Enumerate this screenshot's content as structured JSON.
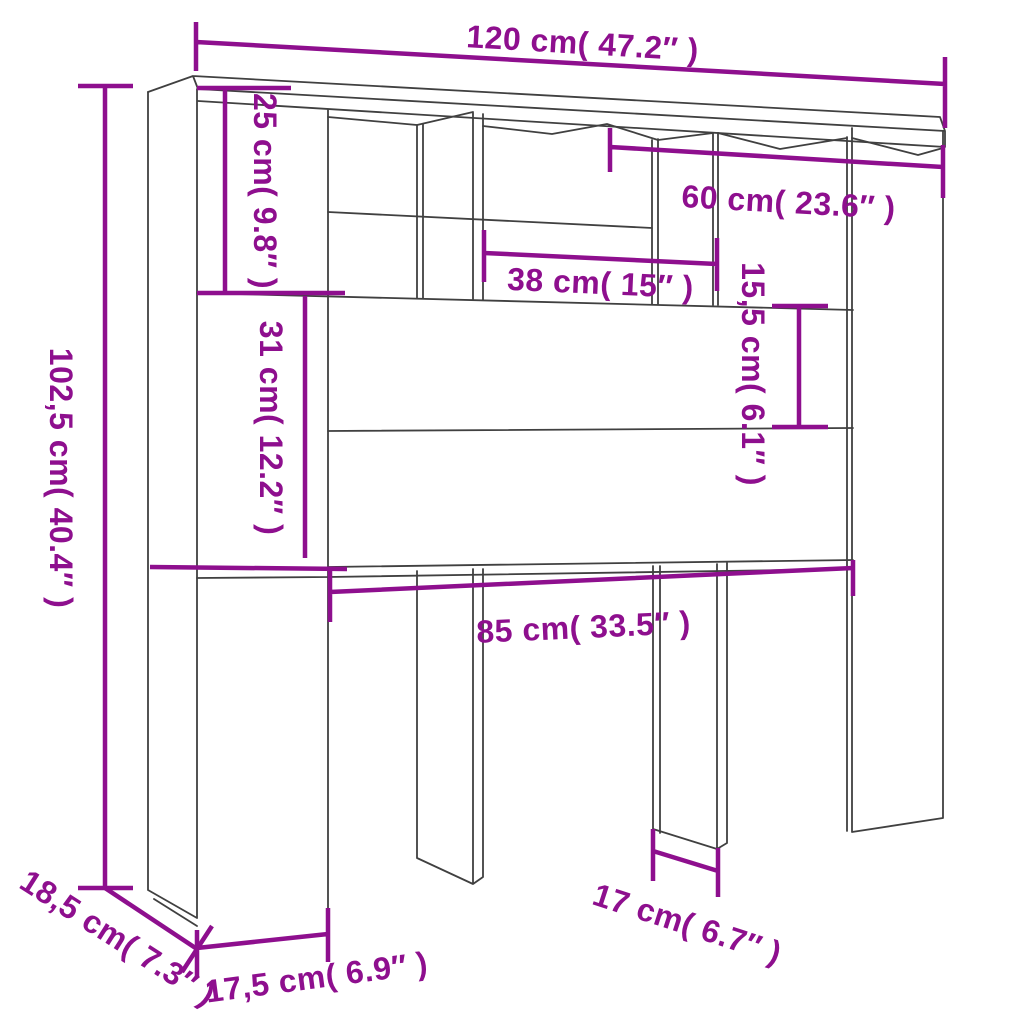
{
  "diagram": {
    "type": "furniture-dimension-diagram",
    "units": [
      "cm",
      "inches"
    ],
    "colors": {
      "dimension_color": "#8e0f8e",
      "outline_color": "#404040",
      "background": "#ffffff"
    },
    "dimensions": [
      {
        "id": "overall-width",
        "label": "120 cm( 47.2″ )",
        "cm": 120,
        "inches": 47.2
      },
      {
        "id": "overall-height",
        "label": "102,5 cm( 40.4″ )",
        "cm": 102.5,
        "inches": 40.4
      },
      {
        "id": "top-section-height",
        "label": "25 cm( 9.8″ )",
        "cm": 25,
        "inches": 9.8
      },
      {
        "id": "upper-panel-height",
        "label": "31 cm( 12.2″ )",
        "cm": 31,
        "inches": 12.2
      },
      {
        "id": "center-cubby-width",
        "label": "38 cm( 15″ )",
        "cm": 38,
        "inches": 15
      },
      {
        "id": "right-section-width",
        "label": "60 cm( 23.6″ )",
        "cm": 60,
        "inches": 23.6
      },
      {
        "id": "shelf-gap-height",
        "label": "15,5 cm( 6.1″ )",
        "cm": 15.5,
        "inches": 6.1
      },
      {
        "id": "lower-opening-width",
        "label": "85 cm( 33.5″ )",
        "cm": 85,
        "inches": 33.5
      },
      {
        "id": "depth",
        "label": "18,5 cm( 7.3″ )",
        "cm": 18.5,
        "inches": 7.3
      },
      {
        "id": "left-foot-width",
        "label": "17,5 cm( 6.9″ )",
        "cm": 17.5,
        "inches": 6.9
      },
      {
        "id": "middle-foot-width",
        "label": "17 cm( 6.7″ )",
        "cm": 17,
        "inches": 6.7
      }
    ]
  }
}
